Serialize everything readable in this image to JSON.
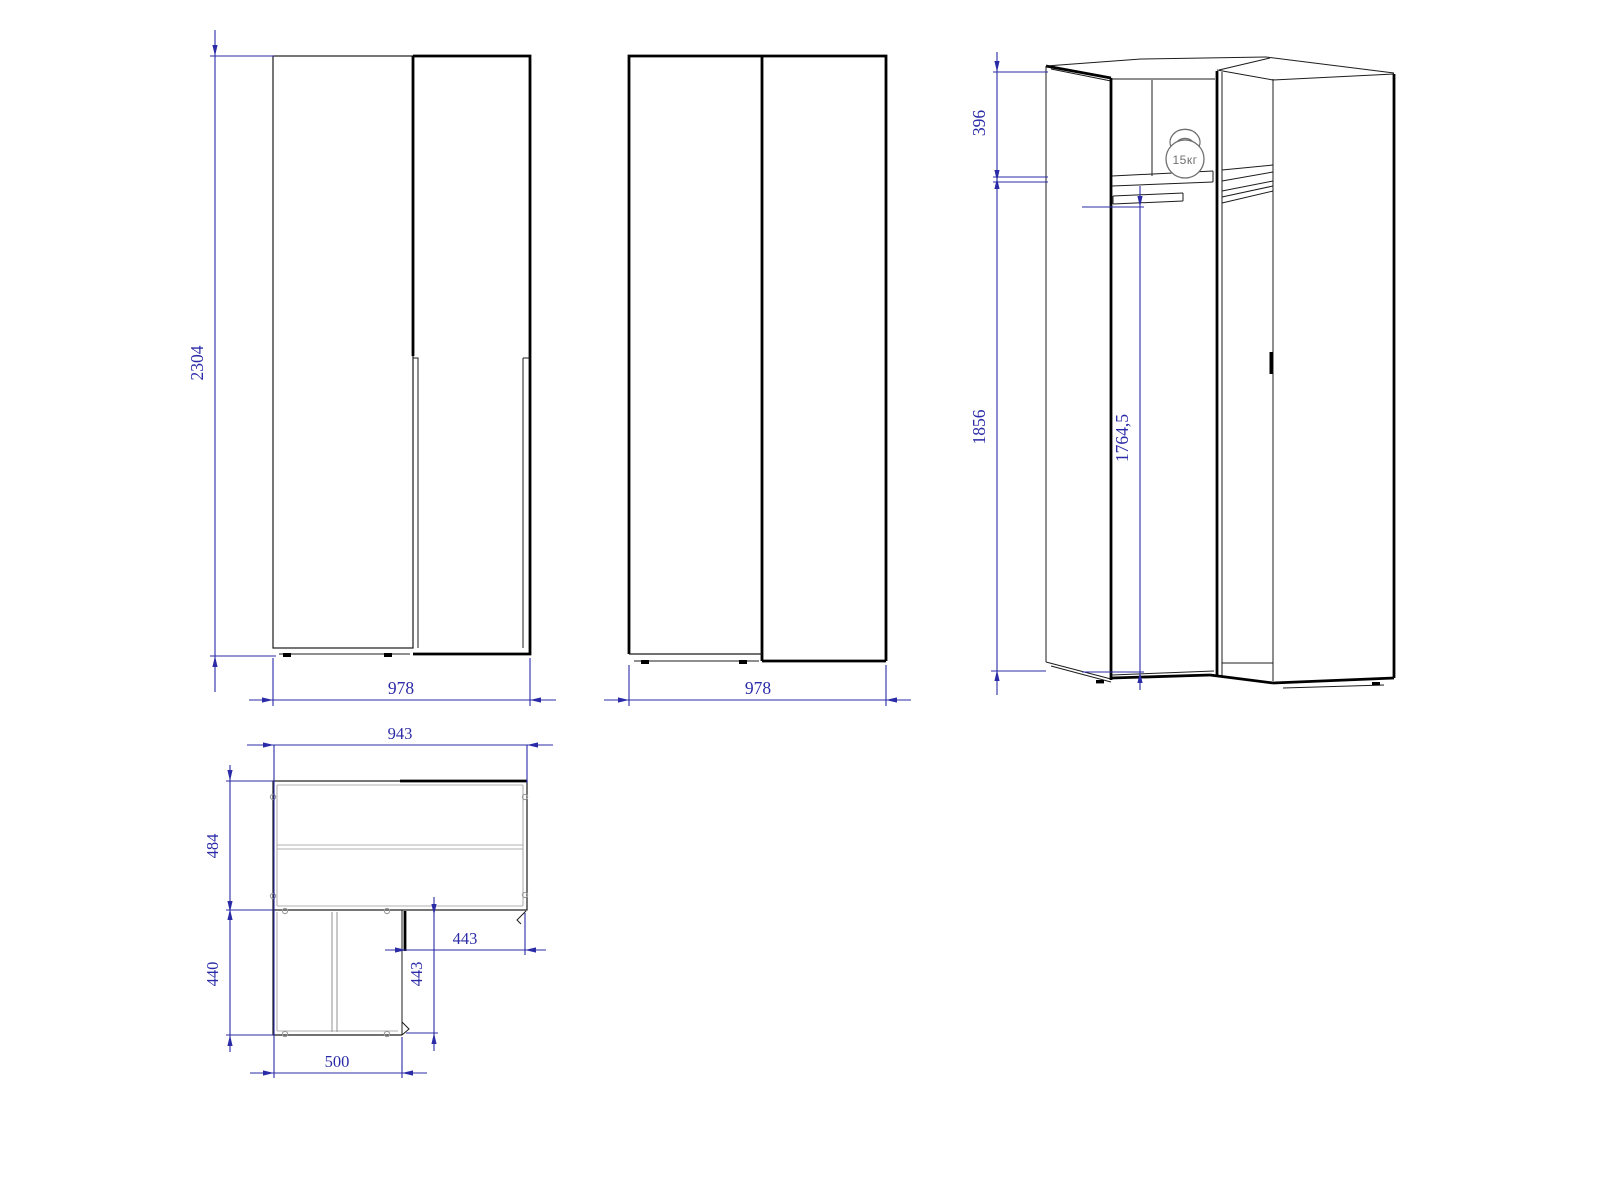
{
  "drawing": {
    "type": "furniture-technical-drawing",
    "subject": "corner wardrobe dimensioned views",
    "colors": {
      "line": "#000000",
      "dimension": "#2b2ba8",
      "secondary": "#b0b0b0",
      "icon": "#6f6f6f",
      "background": "#ffffff"
    },
    "views": {
      "front_a": {
        "height_mm": "2304",
        "width_mm": "978"
      },
      "front_b": {
        "width_mm": "978"
      },
      "iso": {
        "top_section_mm": "396",
        "hanging_section_mm": "1856",
        "rod_height_mm": "1764,5",
        "shelf_load": "15кг"
      },
      "plan": {
        "overall_width_mm": "943",
        "upper_depth_mm": "484",
        "lower_depth_mm": "440",
        "lower_width_mm": "500",
        "inner_width_mm": "443",
        "inner_depth_mm": "443"
      }
    }
  }
}
